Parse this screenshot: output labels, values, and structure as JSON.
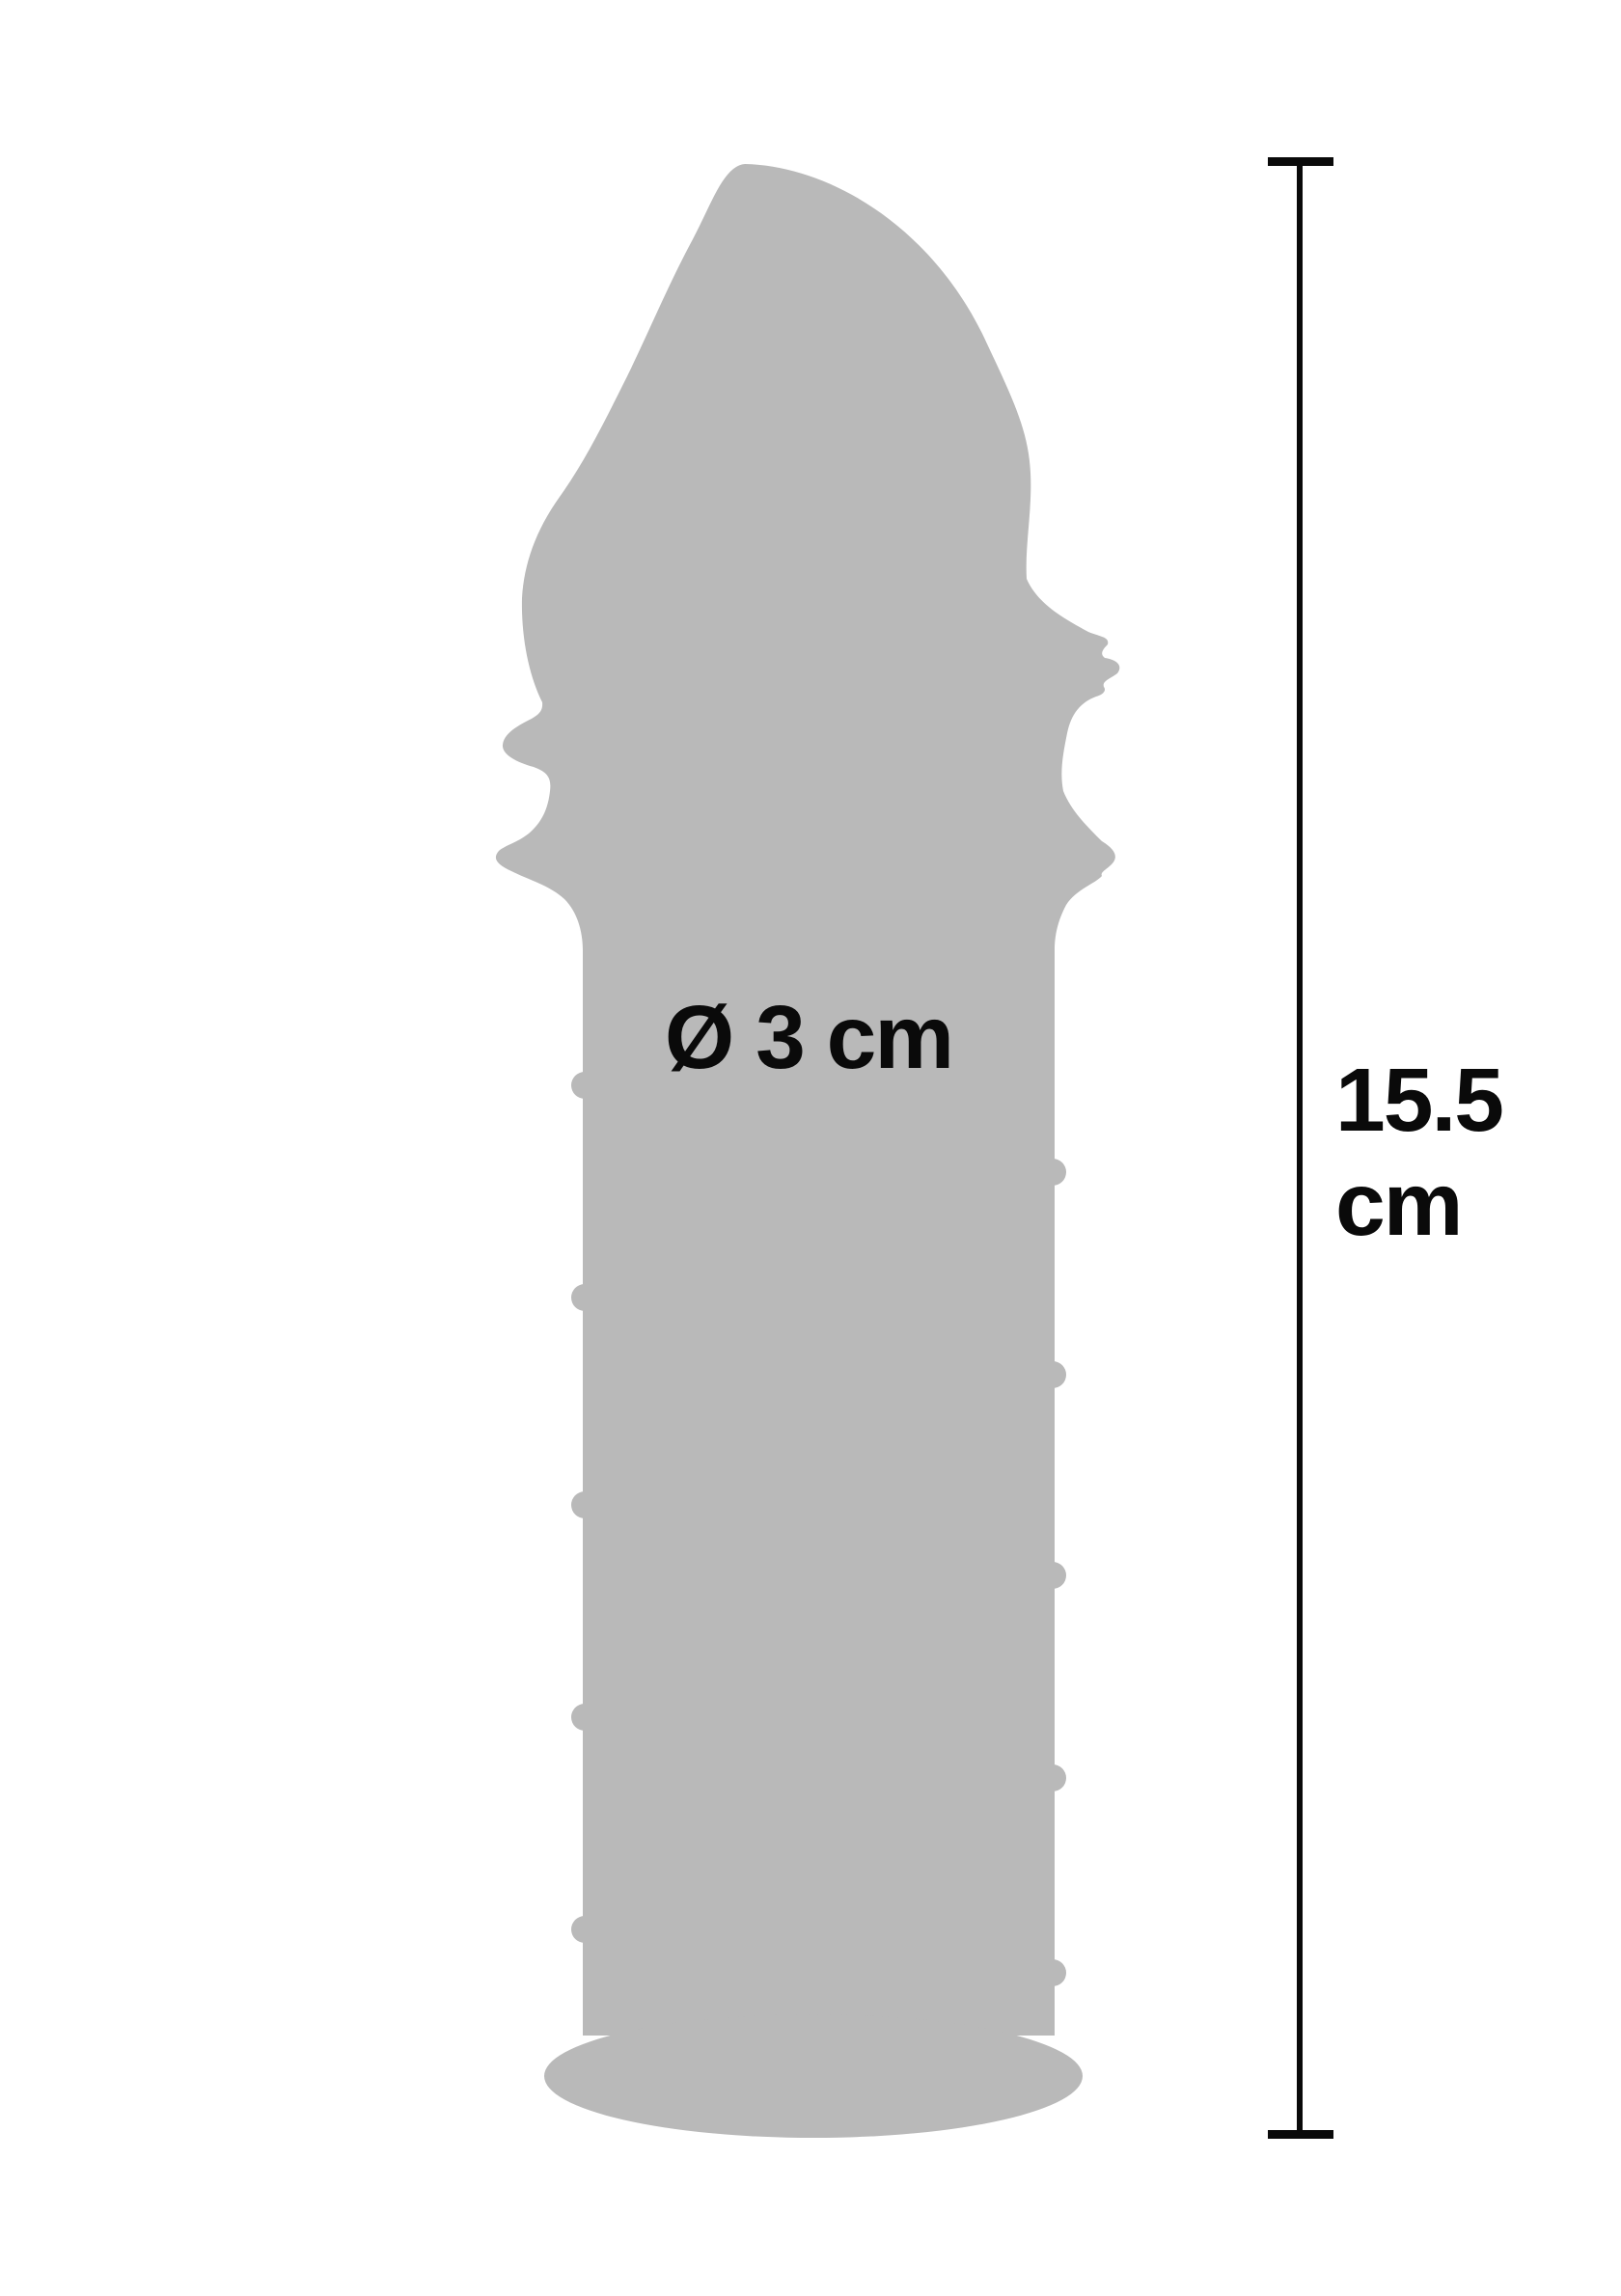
{
  "colors": {
    "background": "#ffffff",
    "product": "#b9b9b9",
    "ink": "#0a0a0a"
  },
  "product": {
    "name": "extension-sleeve-silhouette"
  },
  "dimensions": {
    "diameter_label": "Ø 3 cm",
    "length_value": "15.5",
    "length_unit": "cm"
  }
}
